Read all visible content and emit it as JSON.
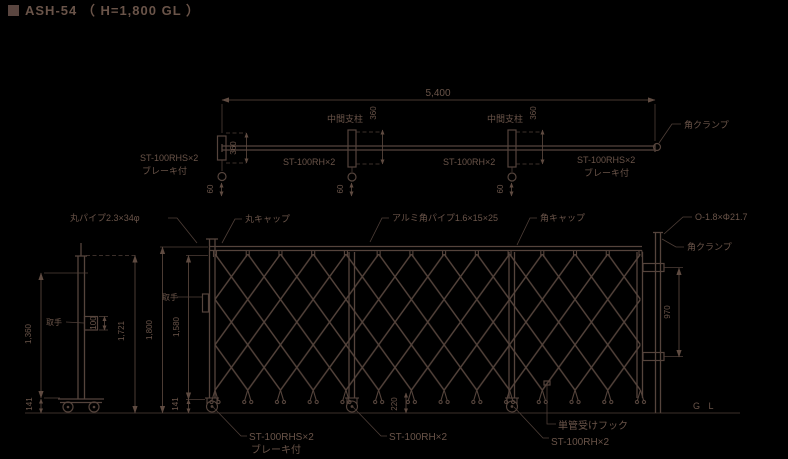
{
  "title": "ASH-54 （ H=1,800 GL ）",
  "plan": {
    "dim_overall_width": "5,400",
    "dim_post_depth": "360",
    "dim_caster_offset": "60",
    "mid_post_label": "中間支柱",
    "span_label": "ST-100RH×2",
    "end_caster_label": "ST-100RHS×2",
    "end_caster_note": "ブレーキ付",
    "clamp_label": "角クランプ"
  },
  "elevation": {
    "part_labels": {
      "round_pipe": "丸パイプ2.3×34φ",
      "round_cap": "丸キャップ",
      "alumi_square_pipe": "アルミ角パイプ1.6×15×25",
      "square_cap": "角キャップ",
      "receive_pipe": "O-1.8×Φ21.7",
      "square_clamp": "角クランプ",
      "handle": "取手",
      "pipe_hook": "単管受けフック",
      "caster_brake": "ST-100RHS×2",
      "caster_brake_note": "ブレーキ付",
      "caster_mid": "ST-100RH×2",
      "ground_level": "G L"
    },
    "dims": {
      "total_height": "1,800",
      "frame_height": "1,580",
      "caster_height": "141",
      "hook_spacing": "970",
      "caster_pitch": "220"
    }
  },
  "side": {
    "handle_label": "取手",
    "dims": {
      "panel_height": "1,360",
      "frame_height": "1,721",
      "caster_height": "141",
      "handle_size": "100"
    }
  }
}
